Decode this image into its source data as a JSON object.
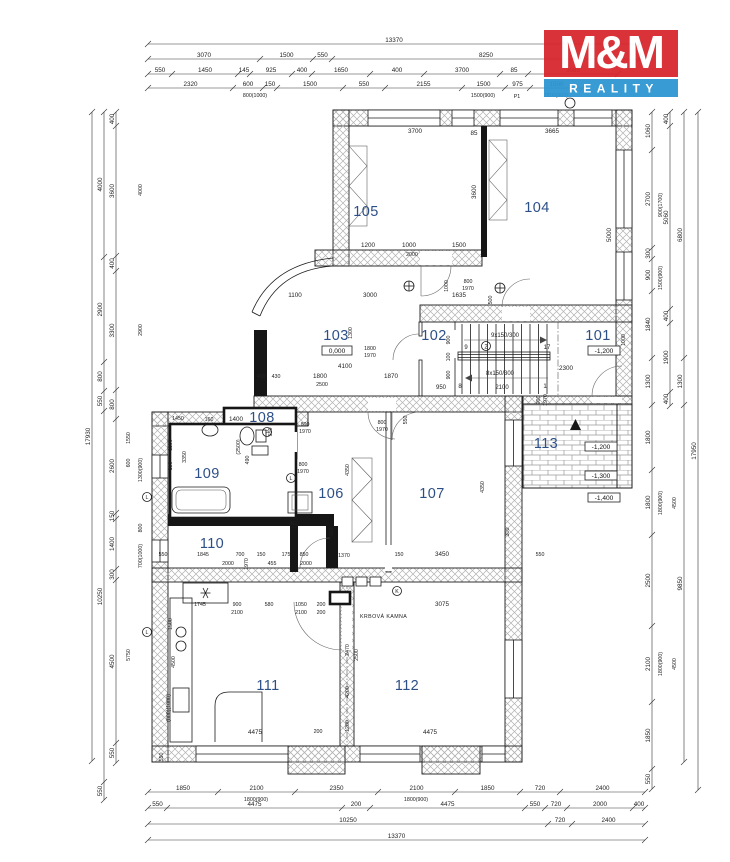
{
  "logo": {
    "title": "M&M",
    "subtitle": "REALITY"
  },
  "colors": {
    "logo_red": "#d7282f",
    "logo_blue": "#2e96d1",
    "room_label": "#2d4f87",
    "white": "#ffffff"
  },
  "rooms": {
    "r101": "101",
    "r102": "102",
    "r103": "103",
    "r104": "104",
    "r105": "105",
    "r106": "106",
    "r107": "107",
    "r108": "108",
    "r109": "109",
    "r110": "110",
    "r111": "111",
    "r112": "112",
    "r113": "113"
  },
  "elev": {
    "e0": "0,000",
    "em12a": "-1,200",
    "em12b": "-1,200",
    "em13": "-1,300",
    "em14": "-1,400"
  },
  "stairs": {
    "up": "9x150/300",
    "down": "8x150/300",
    "n9": "9",
    "n2": "2",
    "n17": "17",
    "n8": "8",
    "n1": "1",
    "n2100": "2100",
    "n950": "950"
  },
  "markers": {
    "p": "P",
    "k2": "K2",
    "l1": "L",
    "l2": "L",
    "lr": "L",
    "k": "K"
  },
  "misc": {
    "fireplace": "KRBOVÁ KAMNA"
  },
  "dims": {
    "t1": [
      "13370"
    ],
    "t2": [
      "3070",
      "1500",
      "550",
      "8250"
    ],
    "t3": [
      "550",
      "1450",
      "145",
      "925",
      "400",
      "1650",
      "400",
      "3700",
      "85",
      "3685"
    ],
    "t4": [
      "2320",
      "600",
      "150",
      "1500",
      "550",
      "2155",
      "1500",
      "975",
      "1500"
    ],
    "b1": [
      "1850",
      "2100",
      "2350",
      "2100",
      "1850",
      "720",
      "2400"
    ],
    "b2": [
      "550",
      "4475",
      "200",
      "4475",
      "550",
      "720",
      "2000",
      "400"
    ],
    "b3": [
      "10250",
      "720",
      "2400"
    ],
    "b4": [
      "13370"
    ],
    "l1": [
      "17930"
    ],
    "l2": [
      "4000",
      "2900",
      "800",
      "550",
      "10250",
      "550"
    ],
    "l3": [
      "400",
      "3600",
      "400",
      "3300",
      "800",
      "2600",
      "150",
      "1400",
      "300",
      "4500",
      "550"
    ],
    "r1": [
      "1060",
      "2700",
      "300",
      "900",
      "1840",
      "1300",
      "1800",
      "1800",
      "2500",
      "2100",
      "1850",
      "550"
    ],
    "r2": [
      "400",
      "5060",
      "400",
      "1900",
      "400"
    ],
    "r3": [
      "6800",
      "1300",
      "9850"
    ],
    "r4": [
      "17950"
    ],
    "sub": {
      "t4a": "800(1000)",
      "t4b": "1500(900)",
      "t4c": "P1",
      "t4d": "1500(900)",
      "b1a": "1800(900)",
      "b1b": "1800(900)",
      "r900_1700": "900(1700)",
      "r1500_900": "1500(900)",
      "r1800_900a": "1800(900)",
      "r4500a": "4500",
      "r1800_900b": "1800(900)",
      "r4500b": "4500",
      "l1550": "1550",
      "l600": "600",
      "l5750": "5750",
      "l1300_900": "1300(900)",
      "l700_1000": "700(1000)",
      "l800": "800",
      "l4000": "4000",
      "l2900": "2900"
    },
    "in": {
      "n3700": "3700",
      "n3600": "3600",
      "n1200": "1200",
      "n1000a": "1000",
      "n1500a": "1500",
      "n2000a": "2000",
      "n3665": "3665",
      "n5000": "5000",
      "n85": "85",
      "n1100": "1100",
      "n3000": "3000",
      "n1635": "1635",
      "d800a": "800",
      "d1970a": "1970",
      "n500": "500",
      "n4100": "4100",
      "n1870": "1870",
      "n1800a": "1800",
      "n2500a": "2500",
      "n400a": "400",
      "n430": "430",
      "d1800": "1800",
      "d1970b": "1970",
      "n1300": "1300",
      "n1000b": "1000",
      "n900a": "900",
      "n100": "100",
      "n900b": "900",
      "n2300": "2300",
      "d900": "900",
      "d1970c": "1970",
      "n1000c": "1000",
      "n1400": "1400",
      "n160": "160",
      "n550a": "550",
      "d800b": "800",
      "d1970d": "1970",
      "n1450": "1450",
      "n1100b": "1100",
      "n150a": "150",
      "n3350": "3350",
      "n2500p": "(2500)",
      "n490": "490",
      "d800c": "800",
      "d1970e": "1970",
      "n4350a": "4350",
      "n4350b": "4350",
      "d800d": "800",
      "d1970f": "1970",
      "n550b": "550",
      "n150b": "150",
      "n3450": "3450",
      "n550c": "550",
      "n300a": "300",
      "n1370": "1370",
      "n175": "175",
      "n850": "850",
      "n455": "455",
      "n2000b": "2000",
      "n550d": "550",
      "n1845": "1845",
      "n700": "700",
      "n2000c": "2000",
      "n150c": "150",
      "n1970g": "1970",
      "n1745": "1745",
      "n900k": "900",
      "n580": "580",
      "n1050": "1050",
      "n200a": "200",
      "n2100a": "2100",
      "n2100b": "2100",
      "n200b": "200",
      "n3075": "3075",
      "n2470": "2470",
      "n2500r": "2500",
      "n4200": "4200",
      "n1200r": "1200",
      "n4475a": "4475",
      "n200c": "200",
      "n4475b": "4475",
      "n1500k": "1500",
      "n4500k": "4500",
      "n8001000": "(800)(1000)",
      "n550e": "550",
      "n300f": "300"
    }
  }
}
